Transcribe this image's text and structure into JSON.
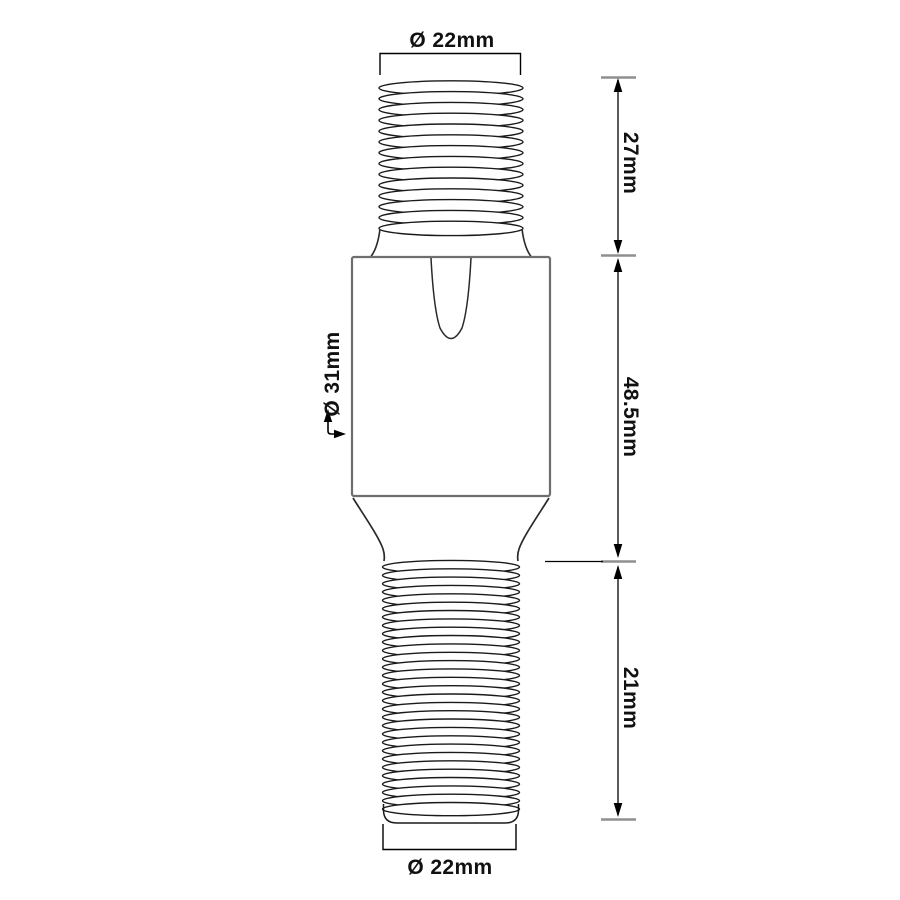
{
  "drawing": {
    "description": "Technical line drawing of a double-ended threaded adapter with a hexagonal-style body, dimensioned",
    "labels": {
      "top_diameter": "Ø 22mm",
      "top_thread_length": "27mm",
      "body_length": "48.5mm",
      "body_diameter": "Ø 31mm",
      "bottom_thread_length": "21mm",
      "bottom_diameter": "Ø 22mm"
    },
    "colors": {
      "background": "#ffffff",
      "thread_line": "#1a1a1a",
      "body_outline": "#6e6e6e",
      "detail_line": "#2a2a2a",
      "dimension_line": "#000000",
      "tick_mark": "#8f8f8f",
      "text": "#111111"
    }
  }
}
